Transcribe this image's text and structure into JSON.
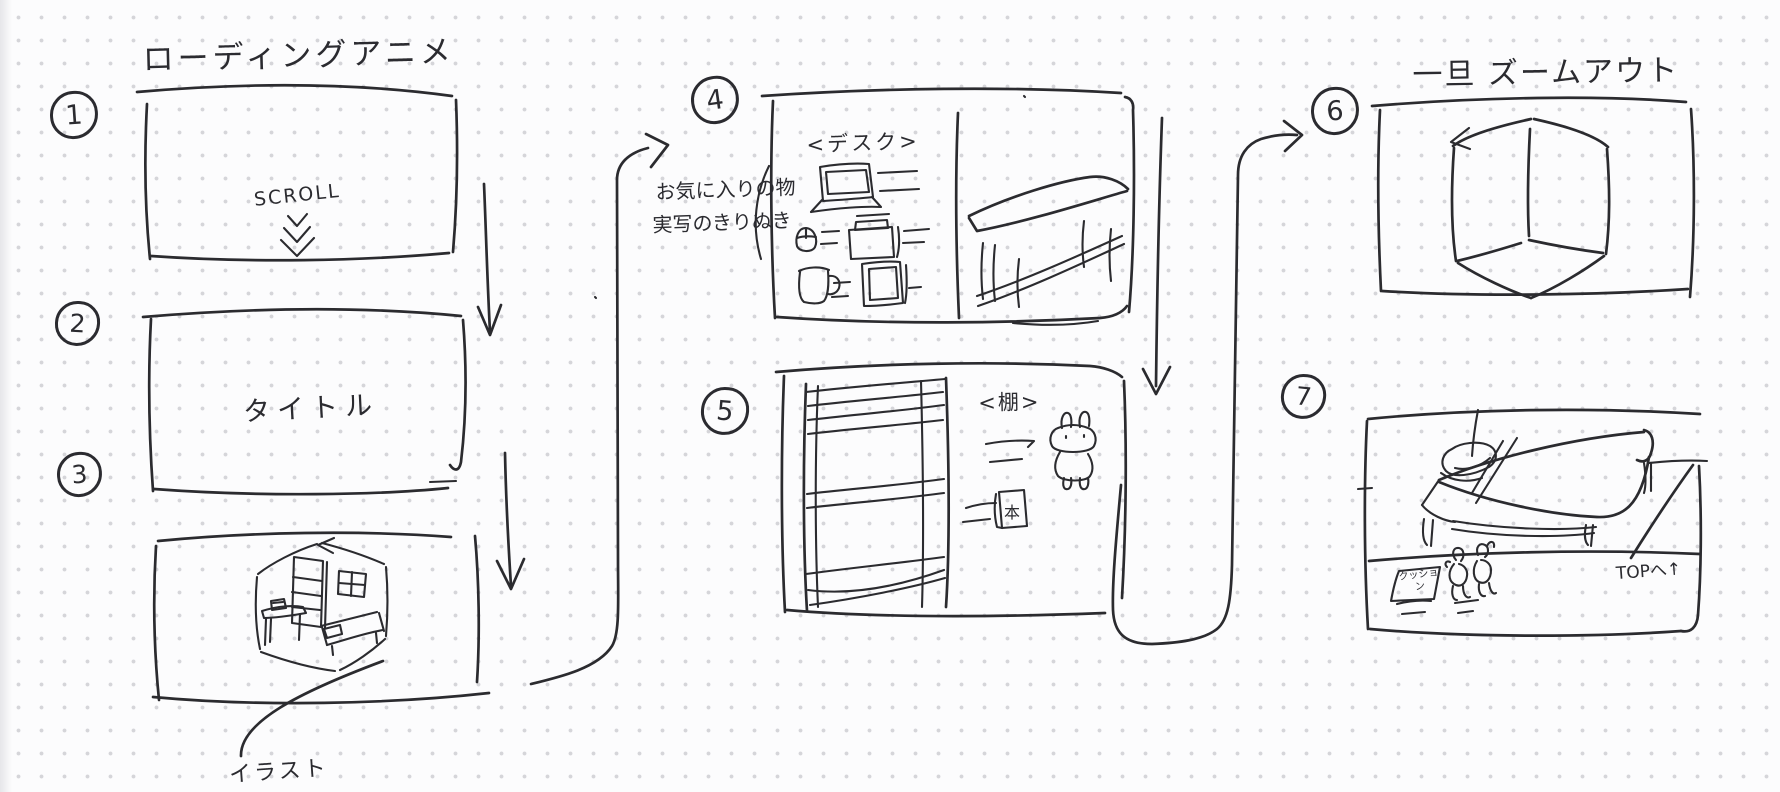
{
  "sketch": {
    "ink_color": "#2b2b2f",
    "paper_color": "#fcfcfd",
    "dot_color": "#d5d5d9"
  },
  "titles": {
    "loading_section": "ローディングアニメ",
    "zoom_out_section": "一旦 ズームアウト"
  },
  "panels": {
    "p1": {
      "number": "1",
      "label": "SCROLL",
      "icon": "triple-chevron-down"
    },
    "p2": {
      "number": "2",
      "label": "タイトル"
    },
    "p3": {
      "number": "3",
      "caption": "イラスト",
      "drawing": "isometric-room-sketch"
    },
    "p4": {
      "number": "4",
      "heading": "<デスク>",
      "note_line1": "お気に入りの物",
      "note_line2": "実写のきりぬき",
      "drawings": [
        "laptop-icon",
        "mouse-icon",
        "radio-box-icon",
        "mug-icon",
        "photo-frame-icon",
        "desk-sketch"
      ]
    },
    "p5": {
      "number": "5",
      "heading": "<棚>",
      "book_label": "本",
      "drawings": [
        "bookshelf-sketch",
        "rabbit-character-doodle",
        "book-icon"
      ]
    },
    "p6": {
      "number": "6",
      "drawing": "room-cube-zoomed-out"
    },
    "p7": {
      "number": "7",
      "cushion_label": "クッション",
      "top_link_label": "TOPへ↑",
      "drawings": [
        "bed-sketch",
        "cushion-tag",
        "plush-doodles"
      ]
    }
  },
  "connectors": [
    "arrow-1-to-2",
    "arrow-2-to-3",
    "arrow-3-to-4",
    "arrow-4-to-5",
    "arrow-5-to-6"
  ]
}
